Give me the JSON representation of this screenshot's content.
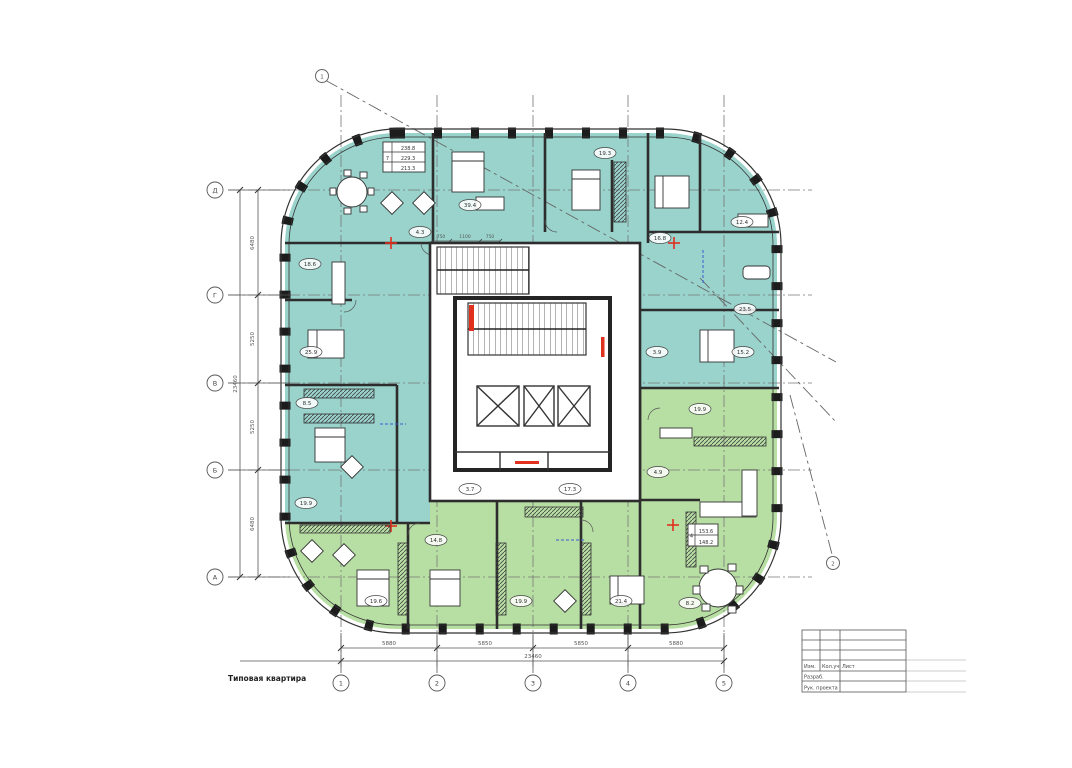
{
  "drawing": {
    "caption": "Типовая квартира",
    "callout_top_left": "1",
    "callout_bottom_right": "2"
  },
  "colors": {
    "zone_teal": "#99d3cc",
    "zone_green": "#b8dfa3",
    "accent_red": "#e0301e",
    "wall": "#2d2d2d"
  },
  "axes": {
    "left": [
      "Д",
      "Г",
      "В",
      "Б",
      "А"
    ],
    "bottom": [
      "1",
      "2",
      "3",
      "4",
      "5"
    ]
  },
  "dims": {
    "left_segments": [
      "6480",
      "5250",
      "5250",
      "6480"
    ],
    "left_total": "23460",
    "bottom_segments": [
      "5880",
      "5850",
      "5850",
      "5880"
    ],
    "bottom_total": "23460",
    "core_top": [
      "750",
      "1100",
      "750"
    ]
  },
  "rooms": [
    "18.6",
    "25.9",
    "8.5",
    "19.9",
    "4.3",
    "39.4",
    "19.3",
    "16.8",
    "12.4",
    "23.5",
    "3.9",
    "15.2",
    "19.9",
    "4.9",
    "17.3",
    "3.7",
    "14.8",
    "19.6",
    "19.9",
    "21.4",
    "8.2"
  ],
  "stamps": {
    "a": {
      "rooms": "7",
      "rows": [
        "238.8",
        "229.3",
        "213.3"
      ]
    },
    "b": {
      "rooms": "4",
      "rows": [
        "153.6",
        "148.2"
      ]
    }
  },
  "titleblock": {
    "col1": "Изм.",
    "col2": "Кол.уч",
    "col3": "Лист",
    "row_razrab": "Разраб.",
    "row_ruk": "Рук. проекта"
  }
}
